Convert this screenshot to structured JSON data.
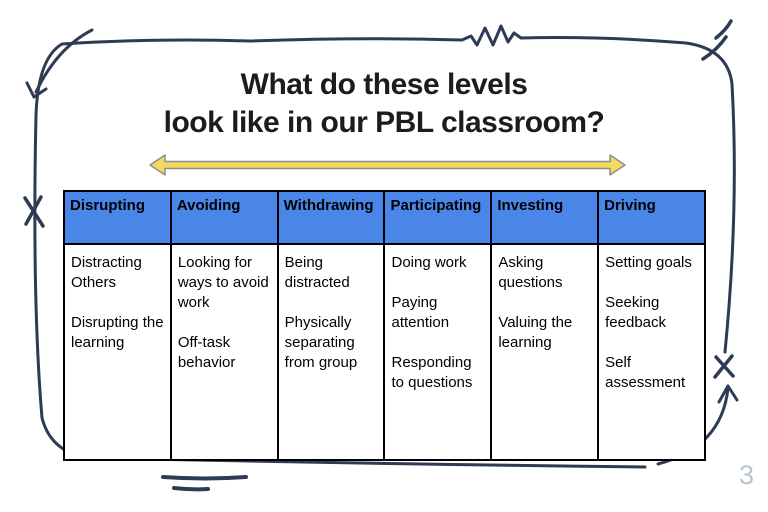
{
  "title": {
    "line1": "What do these levels",
    "line2": "look like in our PBL classroom?"
  },
  "page": {
    "slide_number": "3"
  },
  "colors": {
    "header_blue": "#4a86e8",
    "frame_navy": "#2d3b55",
    "arrow_yellow": "#f5d95e",
    "arrow_outline_gray": "#8f8f8f",
    "table_border_black": "#000000",
    "slide_number_gray": "#b9c3ce"
  },
  "table": {
    "columns": [
      {
        "header": "Disrupting",
        "items": [
          "Distracting Others",
          "Disrupting the learning"
        ]
      },
      {
        "header": "Avoiding",
        "items": [
          "Looking for ways to avoid work",
          "Off-task behavior"
        ]
      },
      {
        "header": "Withdrawing",
        "items": [
          "Being distracted",
          "Physically separating from group"
        ]
      },
      {
        "header": "Participating",
        "items": [
          "Doing work",
          "Paying attention",
          "Responding to questions"
        ]
      },
      {
        "header": "Investing",
        "items": [
          "Asking questions",
          "Valuing the learning"
        ]
      },
      {
        "header": "Driving",
        "items": [
          "Setting goals",
          "Seeking feedback",
          "Self assessment"
        ]
      }
    ]
  }
}
